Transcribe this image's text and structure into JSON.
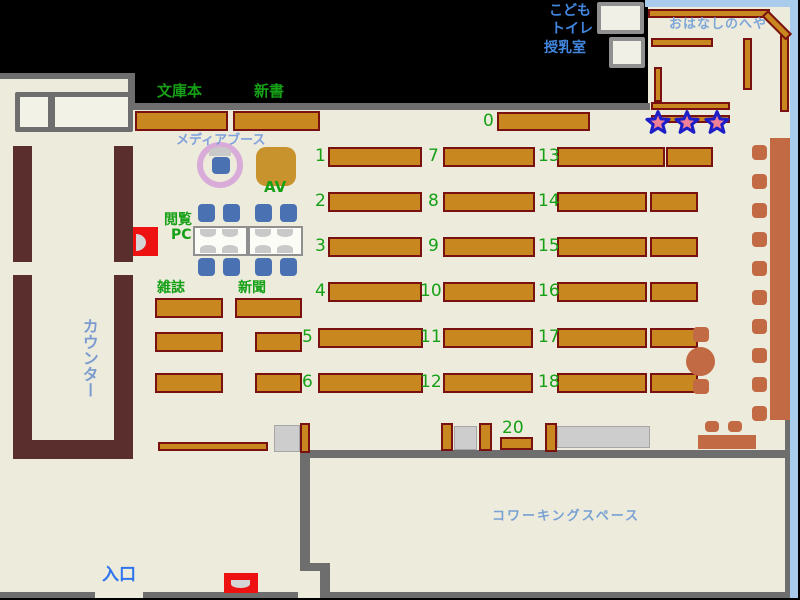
{
  "title": "library-floor-map",
  "colors": {
    "floor": "#edecdc",
    "wall": "#6e6e6e",
    "shelf_fill": "#c8871f",
    "shelf_border": "#7a1111",
    "counter": "#5b2e2e",
    "chair_blue": "#4a72b2",
    "terracotta": "#c26a43",
    "accent_green": "#16a016",
    "edge_blue": "#a9cbec",
    "gate_red": "#ee1111",
    "star_fill": "#ef8095",
    "star_stroke": "#1e1ec8",
    "media_ring": "#d9abd9"
  },
  "labels": [
    {
      "n": "label-kids",
      "t": "こども",
      "x": 549,
      "y": 4,
      "s": 14,
      "col": "#4287e0",
      "b": 1
    },
    {
      "n": "label-toilet",
      "t": "トイレ",
      "x": 551,
      "y": 22,
      "s": 14,
      "col": "#4287e0",
      "b": 1
    },
    {
      "n": "label-nursing-room",
      "t": "授乳室",
      "x": 544,
      "y": 41,
      "s": 14,
      "col": "#4287e0",
      "b": 1
    },
    {
      "n": "label-storytime-room",
      "t": "おはなしのへや",
      "x": 669,
      "y": 18,
      "s": 13,
      "col": "#7ea6d8",
      "b": 1,
      "ls": 1
    },
    {
      "n": "label-paperbacks",
      "t": "文庫本",
      "x": 157,
      "y": 84,
      "s": 15,
      "col": "#16a016",
      "b": 1
    },
    {
      "n": "label-new-books",
      "t": "新書",
      "x": 254,
      "y": 84,
      "s": 15,
      "col": "#16a016",
      "b": 1
    },
    {
      "n": "label-media-booth",
      "t": "メディアブース",
      "x": 176,
      "y": 134,
      "s": 13,
      "col": "#7f9fdd",
      "b": 1
    },
    {
      "n": "label-av",
      "t": "AV",
      "x": 264,
      "y": 180,
      "s": 15,
      "col": "#16a016",
      "b": 1
    },
    {
      "n": "label-browsing",
      "t": "閲覧",
      "x": 164,
      "y": 213,
      "s": 14,
      "col": "#16a016",
      "b": 1
    },
    {
      "n": "label-pc",
      "t": "PC",
      "x": 171,
      "y": 228,
      "s": 14,
      "col": "#16a016",
      "b": 1
    },
    {
      "n": "label-magazines",
      "t": "雑誌",
      "x": 157,
      "y": 281,
      "s": 14,
      "col": "#16a016",
      "b": 1
    },
    {
      "n": "label-newspapers",
      "t": "新聞",
      "x": 238,
      "y": 281,
      "s": 14,
      "col": "#16a016",
      "b": 1
    },
    {
      "n": "label-counter",
      "t": "カウンター",
      "x": 80,
      "y": 318,
      "s": 16,
      "col": "#7b9bd0",
      "b": 1,
      "vert": 1
    },
    {
      "n": "label-entrance",
      "t": "入口",
      "x": 102,
      "y": 567,
      "s": 17,
      "col": "#2f74ee",
      "b": 1
    },
    {
      "n": "label-coworking-space",
      "t": "コワーキングスペース",
      "x": 492,
      "y": 510,
      "s": 13,
      "col": "#79a1d4",
      "b": 1,
      "ls": 2
    }
  ],
  "shelf_numbers": [
    {
      "t": "0",
      "x": 483,
      "y": 111
    },
    {
      "t": "1",
      "x": 315,
      "y": 146
    },
    {
      "t": "2",
      "x": 315,
      "y": 191
    },
    {
      "t": "3",
      "x": 315,
      "y": 236
    },
    {
      "t": "4",
      "x": 315,
      "y": 281
    },
    {
      "t": "5",
      "x": 302,
      "y": 327
    },
    {
      "t": "6",
      "x": 302,
      "y": 372
    },
    {
      "t": "7",
      "x": 428,
      "y": 146
    },
    {
      "t": "8",
      "x": 428,
      "y": 191
    },
    {
      "t": "9",
      "x": 428,
      "y": 236
    },
    {
      "t": "10",
      "x": 420,
      "y": 281
    },
    {
      "t": "11",
      "x": 420,
      "y": 327
    },
    {
      "t": "12",
      "x": 420,
      "y": 372
    },
    {
      "t": "13",
      "x": 538,
      "y": 146
    },
    {
      "t": "14",
      "x": 538,
      "y": 191
    },
    {
      "t": "15",
      "x": 538,
      "y": 236
    },
    {
      "t": "16",
      "x": 538,
      "y": 281
    },
    {
      "t": "17",
      "x": 538,
      "y": 327
    },
    {
      "t": "18",
      "x": 538,
      "y": 372
    },
    {
      "t": "20",
      "x": 502,
      "y": 418
    }
  ],
  "map": {
    "floor": [
      0,
      73,
      790,
      525
    ],
    "black_region": [
      [
        133,
        0,
        515,
        103
      ]
    ],
    "story_floor": [
      [
        648,
        7,
        142,
        96
      ]
    ],
    "walls": [
      [
        0,
        73,
        135,
        6
      ],
      [
        128,
        73,
        7,
        37
      ],
      [
        128,
        103,
        522,
        7
      ],
      [
        0,
        592,
        95,
        6
      ],
      [
        143,
        592,
        155,
        6
      ],
      [
        300,
        450,
        487,
        8
      ],
      [
        300,
        452,
        10,
        118
      ],
      [
        300,
        563,
        30,
        8
      ],
      [
        320,
        563,
        10,
        32
      ],
      [
        320,
        592,
        467,
        6
      ],
      [
        785,
        213,
        5,
        385
      ]
    ],
    "blue_borders": [
      [
        645,
        0,
        153,
        7
      ],
      [
        790,
        0,
        8,
        598
      ]
    ],
    "desk_cells": [
      [
        15,
        92,
        38,
        40
      ],
      [
        50,
        92,
        83,
        40
      ]
    ],
    "white_rooms": [
      [
        597,
        2,
        47,
        32
      ],
      [
        609,
        37,
        36,
        31
      ]
    ],
    "counter": [
      [
        13,
        146,
        19,
        116
      ],
      [
        114,
        146,
        19,
        116
      ],
      [
        13,
        275,
        19,
        184
      ],
      [
        114,
        275,
        19,
        165
      ],
      [
        13,
        440,
        120,
        19
      ]
    ],
    "gray_tables": [
      [
        274,
        425,
        26,
        27
      ],
      [
        454,
        426,
        23,
        24
      ],
      [
        557,
        426,
        93,
        22
      ]
    ],
    "shelves": [
      [
        135,
        111,
        93,
        20
      ],
      [
        233,
        111,
        87,
        20
      ],
      [
        497,
        112,
        93,
        19
      ],
      [
        328,
        147,
        94,
        20
      ],
      [
        328,
        192,
        94,
        20
      ],
      [
        328,
        237,
        94,
        20
      ],
      [
        328,
        282,
        94,
        20
      ],
      [
        318,
        328,
        105,
        20
      ],
      [
        318,
        373,
        105,
        20
      ],
      [
        443,
        147,
        92,
        20
      ],
      [
        443,
        192,
        92,
        20
      ],
      [
        443,
        237,
        92,
        20
      ],
      [
        443,
        282,
        92,
        20
      ],
      [
        443,
        328,
        90,
        20
      ],
      [
        443,
        373,
        90,
        20
      ],
      [
        557,
        147,
        108,
        20
      ],
      [
        666,
        147,
        47,
        20
      ],
      [
        557,
        192,
        90,
        20
      ],
      [
        650,
        192,
        48,
        20
      ],
      [
        557,
        237,
        90,
        20
      ],
      [
        650,
        237,
        48,
        20
      ],
      [
        557,
        282,
        90,
        20
      ],
      [
        650,
        282,
        48,
        20
      ],
      [
        557,
        328,
        90,
        20
      ],
      [
        650,
        328,
        48,
        20
      ],
      [
        557,
        373,
        90,
        20
      ],
      [
        650,
        373,
        48,
        20
      ],
      [
        155,
        298,
        68,
        20
      ],
      [
        155,
        332,
        68,
        20
      ],
      [
        155,
        373,
        68,
        20
      ],
      [
        235,
        298,
        67,
        20
      ],
      [
        255,
        332,
        47,
        20
      ],
      [
        255,
        373,
        47,
        20
      ],
      [
        158,
        442,
        110,
        9
      ],
      [
        300,
        423,
        10,
        30
      ],
      [
        441,
        423,
        12,
        28
      ],
      [
        479,
        423,
        13,
        28
      ],
      [
        545,
        423,
        12,
        29
      ],
      [
        500,
        437,
        33,
        13
      ],
      [
        648,
        9,
        122,
        9
      ],
      [
        780,
        32,
        9,
        80
      ],
      [
        651,
        38,
        62,
        9
      ],
      [
        743,
        38,
        9,
        52
      ],
      [
        654,
        67,
        8,
        35
      ],
      [
        651,
        102,
        79,
        8
      ],
      [
        651,
        115,
        79,
        8
      ]
    ],
    "shelf_rot": [
      [
        768,
        10,
        34,
        9,
        45
      ]
    ],
    "pc_cells": [
      [
        193,
        226,
        55,
        30
      ],
      [
        248,
        226,
        55,
        30
      ]
    ],
    "monitors_down": [
      [
        200,
        229,
        16,
        8
      ],
      [
        222,
        229,
        16,
        8
      ],
      [
        255,
        229,
        16,
        8
      ],
      [
        277,
        229,
        16,
        8
      ]
    ],
    "monitors_up": [
      [
        200,
        245,
        16,
        8
      ],
      [
        222,
        245,
        16,
        8
      ],
      [
        255,
        245,
        16,
        8
      ],
      [
        277,
        245,
        16,
        8
      ]
    ],
    "media_ring": [
      [
        197,
        142,
        46,
        46
      ]
    ],
    "media_screen": [
      [
        209,
        147,
        22,
        9
      ]
    ],
    "chairs_blue": [
      [
        198,
        204,
        17,
        18
      ],
      [
        223,
        204,
        17,
        18
      ],
      [
        255,
        204,
        17,
        18
      ],
      [
        280,
        204,
        17,
        18
      ],
      [
        198,
        258,
        17,
        18
      ],
      [
        223,
        258,
        17,
        18
      ],
      [
        255,
        258,
        17,
        18
      ],
      [
        280,
        258,
        17,
        18
      ],
      [
        212,
        157,
        18,
        17
      ]
    ],
    "av_box": [
      [
        256,
        147,
        40,
        39
      ]
    ],
    "terra_strip": [
      [
        770,
        138,
        20,
        282
      ]
    ],
    "chairs_terra": [
      [
        752,
        145,
        15,
        15
      ],
      [
        752,
        174,
        15,
        15
      ],
      [
        752,
        203,
        15,
        15
      ],
      [
        752,
        232,
        15,
        15
      ],
      [
        752,
        261,
        15,
        15
      ],
      [
        752,
        290,
        15,
        15
      ],
      [
        752,
        319,
        15,
        15
      ],
      [
        752,
        348,
        15,
        15
      ],
      [
        752,
        377,
        15,
        15
      ],
      [
        752,
        406,
        15,
        15
      ],
      [
        693,
        327,
        16,
        15
      ],
      [
        693,
        379,
        16,
        15
      ],
      [
        705,
        421,
        14,
        11
      ],
      [
        728,
        421,
        14,
        11
      ]
    ],
    "circle_table": [
      [
        686,
        347,
        29,
        29
      ]
    ],
    "bench": [
      [
        698,
        435,
        58,
        14
      ]
    ],
    "red_gates": [
      [
        133,
        227,
        25,
        29
      ],
      [
        224,
        573,
        34,
        20
      ]
    ],
    "gate_dome_right": [
      [
        136,
        234,
        10,
        17
      ]
    ],
    "gate_dome_down": [
      [
        231,
        580,
        19,
        8
      ]
    ],
    "stars": [
      {
        "cx": 658,
        "cy": 123
      },
      {
        "cx": 687,
        "cy": 123
      },
      {
        "cx": 717,
        "cy": 123
      }
    ]
  }
}
